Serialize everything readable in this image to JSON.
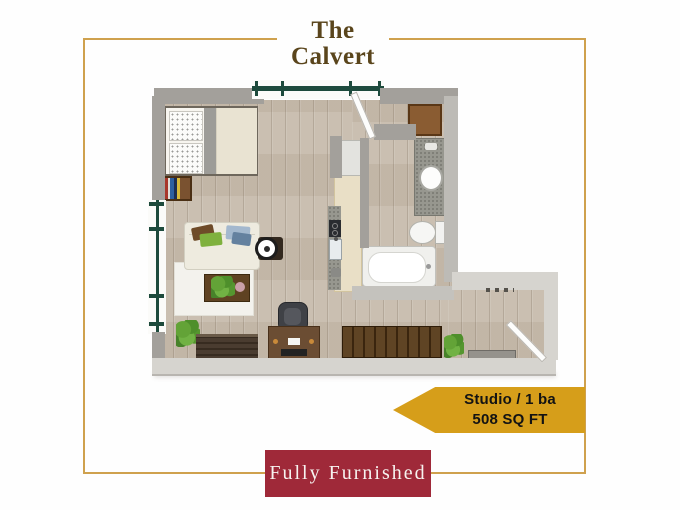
{
  "header": {
    "title_line1": "The",
    "title_line2": "Calvert"
  },
  "badge": {
    "line1": "Studio / 1 ba",
    "line2": "508 SQ FT"
  },
  "banner": {
    "label": "Fully Furnished"
  },
  "colors": {
    "frame_gold": "#cfa14e",
    "title_brown": "#5a451c",
    "badge_gold": "#d69e1a",
    "badge_text": "#131313",
    "banner_maroon": "#9f2939",
    "banner_text": "#f7f3f0",
    "wall_gray": "#a3a09b",
    "wall_light": "#d6d4cf",
    "floor_wood": "#c7bbac",
    "window_green": "#1d4a3c",
    "rug_white": "#f3f2ed"
  },
  "floorplan": {
    "furniture": [
      "bed",
      "pillows",
      "bookshelf",
      "sofa",
      "area-rug",
      "coffee-table",
      "side-table",
      "floor-plant",
      "media-bench",
      "desk",
      "office-chair",
      "kitchen-island",
      "cooktop",
      "kitchen-sink",
      "refrigerator",
      "bathroom-cabinet",
      "vanity-sink",
      "toilet",
      "bathtub",
      "balcony-door",
      "entry-door",
      "hallway-bench",
      "doormat"
    ]
  }
}
